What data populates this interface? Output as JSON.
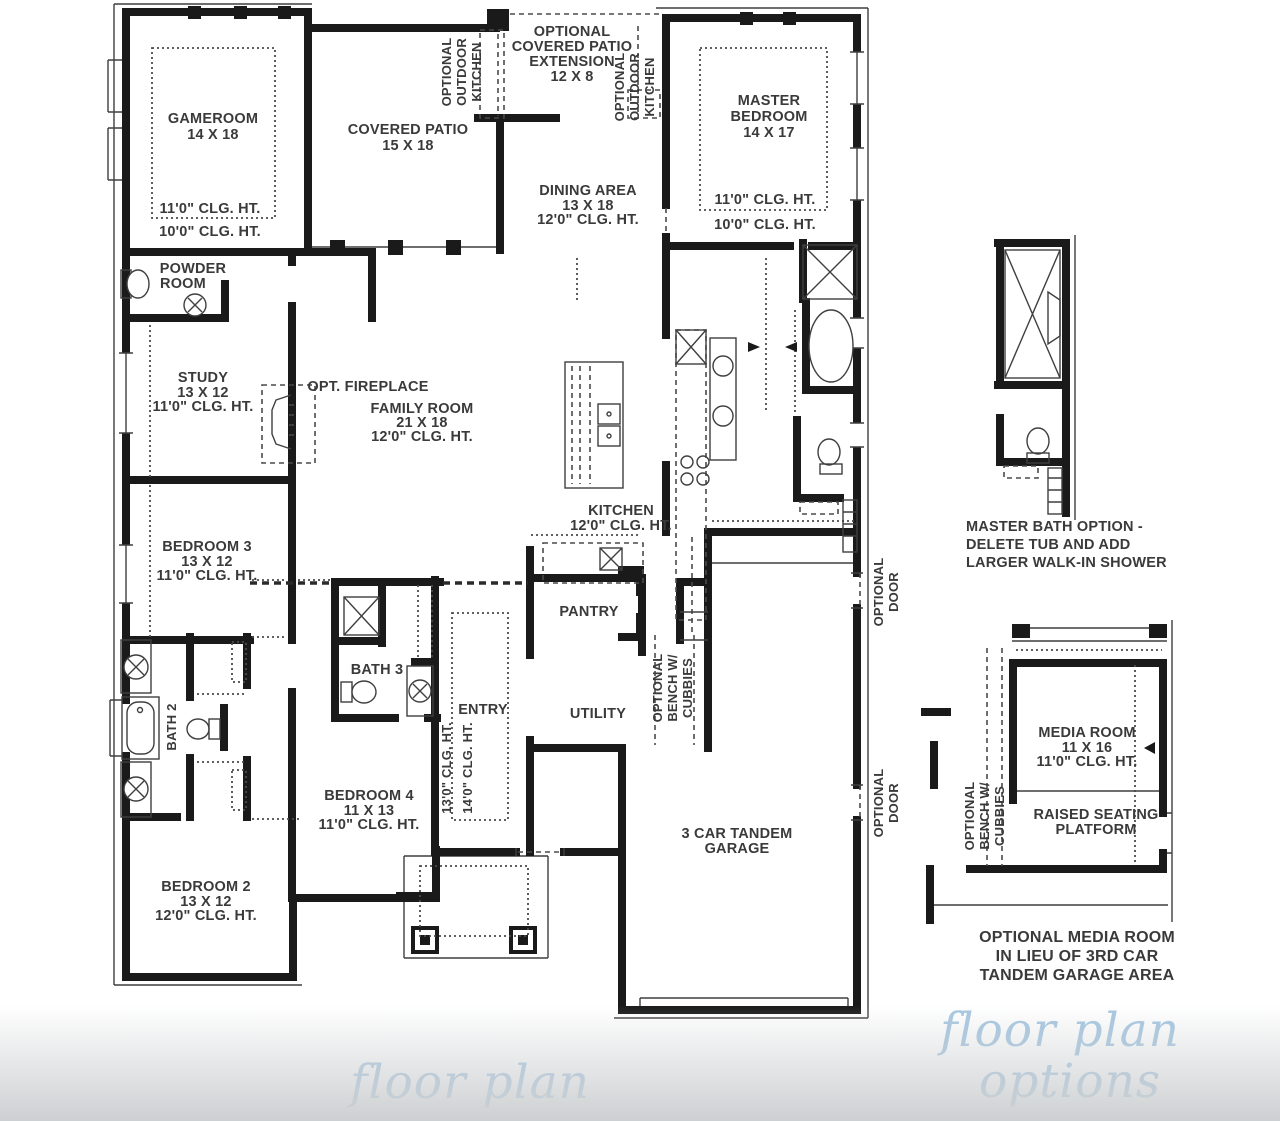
{
  "palette": {
    "wall_color": "#1a1a1a",
    "label_color": "#3a3a3a",
    "caption_blue": "#a5c6e1",
    "background": "#ffffff",
    "fade_gray": "#cdd0d2"
  },
  "main_plan": {
    "gameroom": {
      "name": "GAMEROOM",
      "dims": "14 X 18",
      "clg_upper": "11'0\" CLG. HT.",
      "clg_lower": "10'0\" CLG. HT."
    },
    "covered_patio": {
      "name": "COVERED PATIO",
      "dims": "15 X 18"
    },
    "patio_extension": {
      "line1": "OPTIONAL",
      "line2": "COVERED PATIO",
      "line3": "EXTENSION",
      "dims": "12 X 8"
    },
    "outdoor_kitchen_left": {
      "line1": "OPTIONAL",
      "line2": "OUTDOOR",
      "line3": "KITCHEN"
    },
    "outdoor_kitchen_right": {
      "line1": "OPTIONAL",
      "line2": "OUTDOOR",
      "line3": "KITCHEN"
    },
    "master_bedroom": {
      "line1": "MASTER",
      "line2": "BEDROOM",
      "dims": "14 X 17",
      "clg_upper": "11'0\" CLG. HT.",
      "clg_lower": "10'0\" CLG. HT."
    },
    "dining": {
      "name": "DINING AREA",
      "dims": "13 X 18",
      "clg": "12'0\" CLG. HT."
    },
    "powder": {
      "line1": "POWDER",
      "line2": "ROOM"
    },
    "study": {
      "name": "STUDY",
      "dims": "13 X 12",
      "clg": "11'0\" CLG. HT."
    },
    "fireplace": {
      "name": "OPT. FIREPLACE"
    },
    "family_room": {
      "name": "FAMILY ROOM",
      "dims": "21 X 18",
      "clg": "12'0\" CLG. HT."
    },
    "kitchen": {
      "name": "KITCHEN",
      "clg": "12'0\" CLG. HT."
    },
    "pantry": {
      "name": "PANTRY"
    },
    "bedroom3": {
      "name": "BEDROOM 3",
      "dims": "13 X 12",
      "clg": "11'0\" CLG. HT."
    },
    "bath2": {
      "name": "BATH 2"
    },
    "bath3": {
      "name": "BATH 3"
    },
    "entry": {
      "name": "ENTRY",
      "clg_a": "13'0\" CLG. HT.",
      "clg_b": "14'0\" CLG. HT."
    },
    "utility": {
      "name": "UTILITY"
    },
    "bench": {
      "line1": "OPTIONAL",
      "line2": "BENCH W/",
      "line3": "CUBBIES"
    },
    "bedroom4": {
      "name": "BEDROOM 4",
      "dims": "11 X 13",
      "clg": "11'0\" CLG. HT."
    },
    "bedroom2": {
      "name": "BEDROOM 2",
      "dims": "13 X 12",
      "clg": "12'0\" CLG. HT."
    },
    "garage": {
      "line1": "3 CAR TANDEM",
      "line2": "GARAGE"
    },
    "optional_door_upper": {
      "line1": "OPTIONAL",
      "line2": "DOOR"
    },
    "optional_door_lower": {
      "line1": "OPTIONAL",
      "line2": "DOOR"
    }
  },
  "options_plan": {
    "master_bath_caption": {
      "line1": "MASTER BATH OPTION -",
      "line2": "DELETE TUB AND ADD",
      "line3": "LARGER WALK-IN SHOWER"
    },
    "media_room": {
      "name": "MEDIA ROOM",
      "dims": "11 X 16",
      "clg": "11'0\" CLG. HT."
    },
    "platform": {
      "line1": "RAISED SEATING",
      "line2": "PLATFORM"
    },
    "options_bench": {
      "line1": "OPTIONAL",
      "line2": "BENCH W/",
      "line3": "CUBBIES"
    },
    "media_caption": {
      "line1": "OPTIONAL MEDIA ROOM",
      "line2": "IN LIEU OF 3RD CAR",
      "line3": "TANDEM GARAGE AREA"
    }
  },
  "captions": {
    "floor_plan": "floor plan",
    "options_line1": "floor plan",
    "options_line2": "options"
  }
}
